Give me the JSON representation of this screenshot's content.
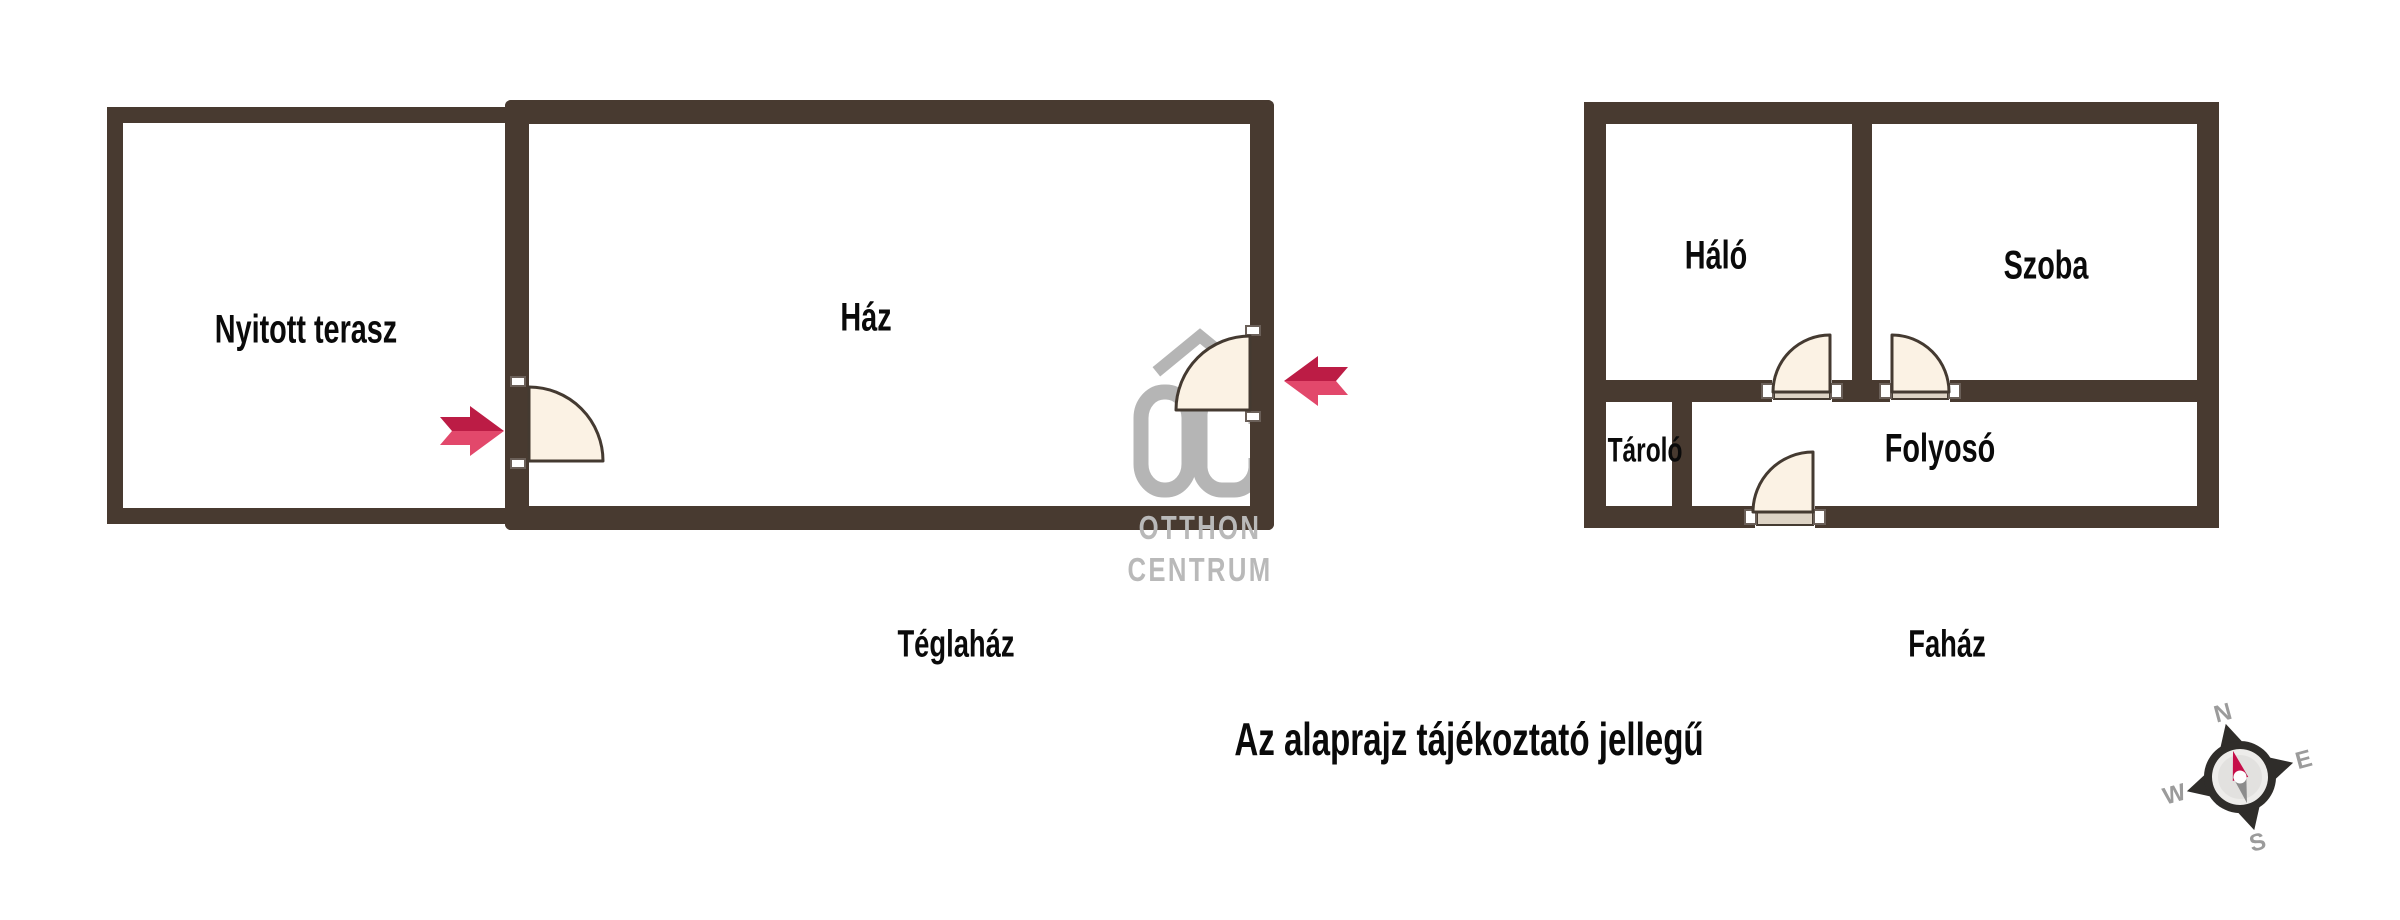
{
  "caption": "Az alaprajz tájékoztató jellegű",
  "plans": {
    "teglahaz": {
      "name": "Téglaház",
      "rooms": {
        "terasz": {
          "label": "Nyitott terasz"
        },
        "haz": {
          "label": "Ház"
        }
      }
    },
    "fahaz": {
      "name": "Faház",
      "rooms": {
        "halo": {
          "label": "Háló"
        },
        "szoba": {
          "label": "Szoba"
        },
        "tarolo": {
          "label": "Tároló"
        },
        "folyoso": {
          "label": "Folyosó"
        }
      }
    }
  },
  "watermark": {
    "monogram": "OC",
    "line1": "OTTHON",
    "line2": "CENTRUM"
  },
  "compass": {
    "n": "N",
    "e": "E",
    "s": "S",
    "w": "W"
  },
  "colors": {
    "wall": "#483A30",
    "door_fill": "#FBF2E4",
    "door_stroke": "#443A31",
    "threshold": "#DDD3C5",
    "watermark_grey": "#B5B5B5",
    "arrow_pink": "#E2486B",
    "arrow_dark": "#BC1C45",
    "compass_ring": "#2F2D2A",
    "needle_red": "#C60E49",
    "needle_grey": "#8C8C8C",
    "compass_letters": "#9B9B9B"
  }
}
